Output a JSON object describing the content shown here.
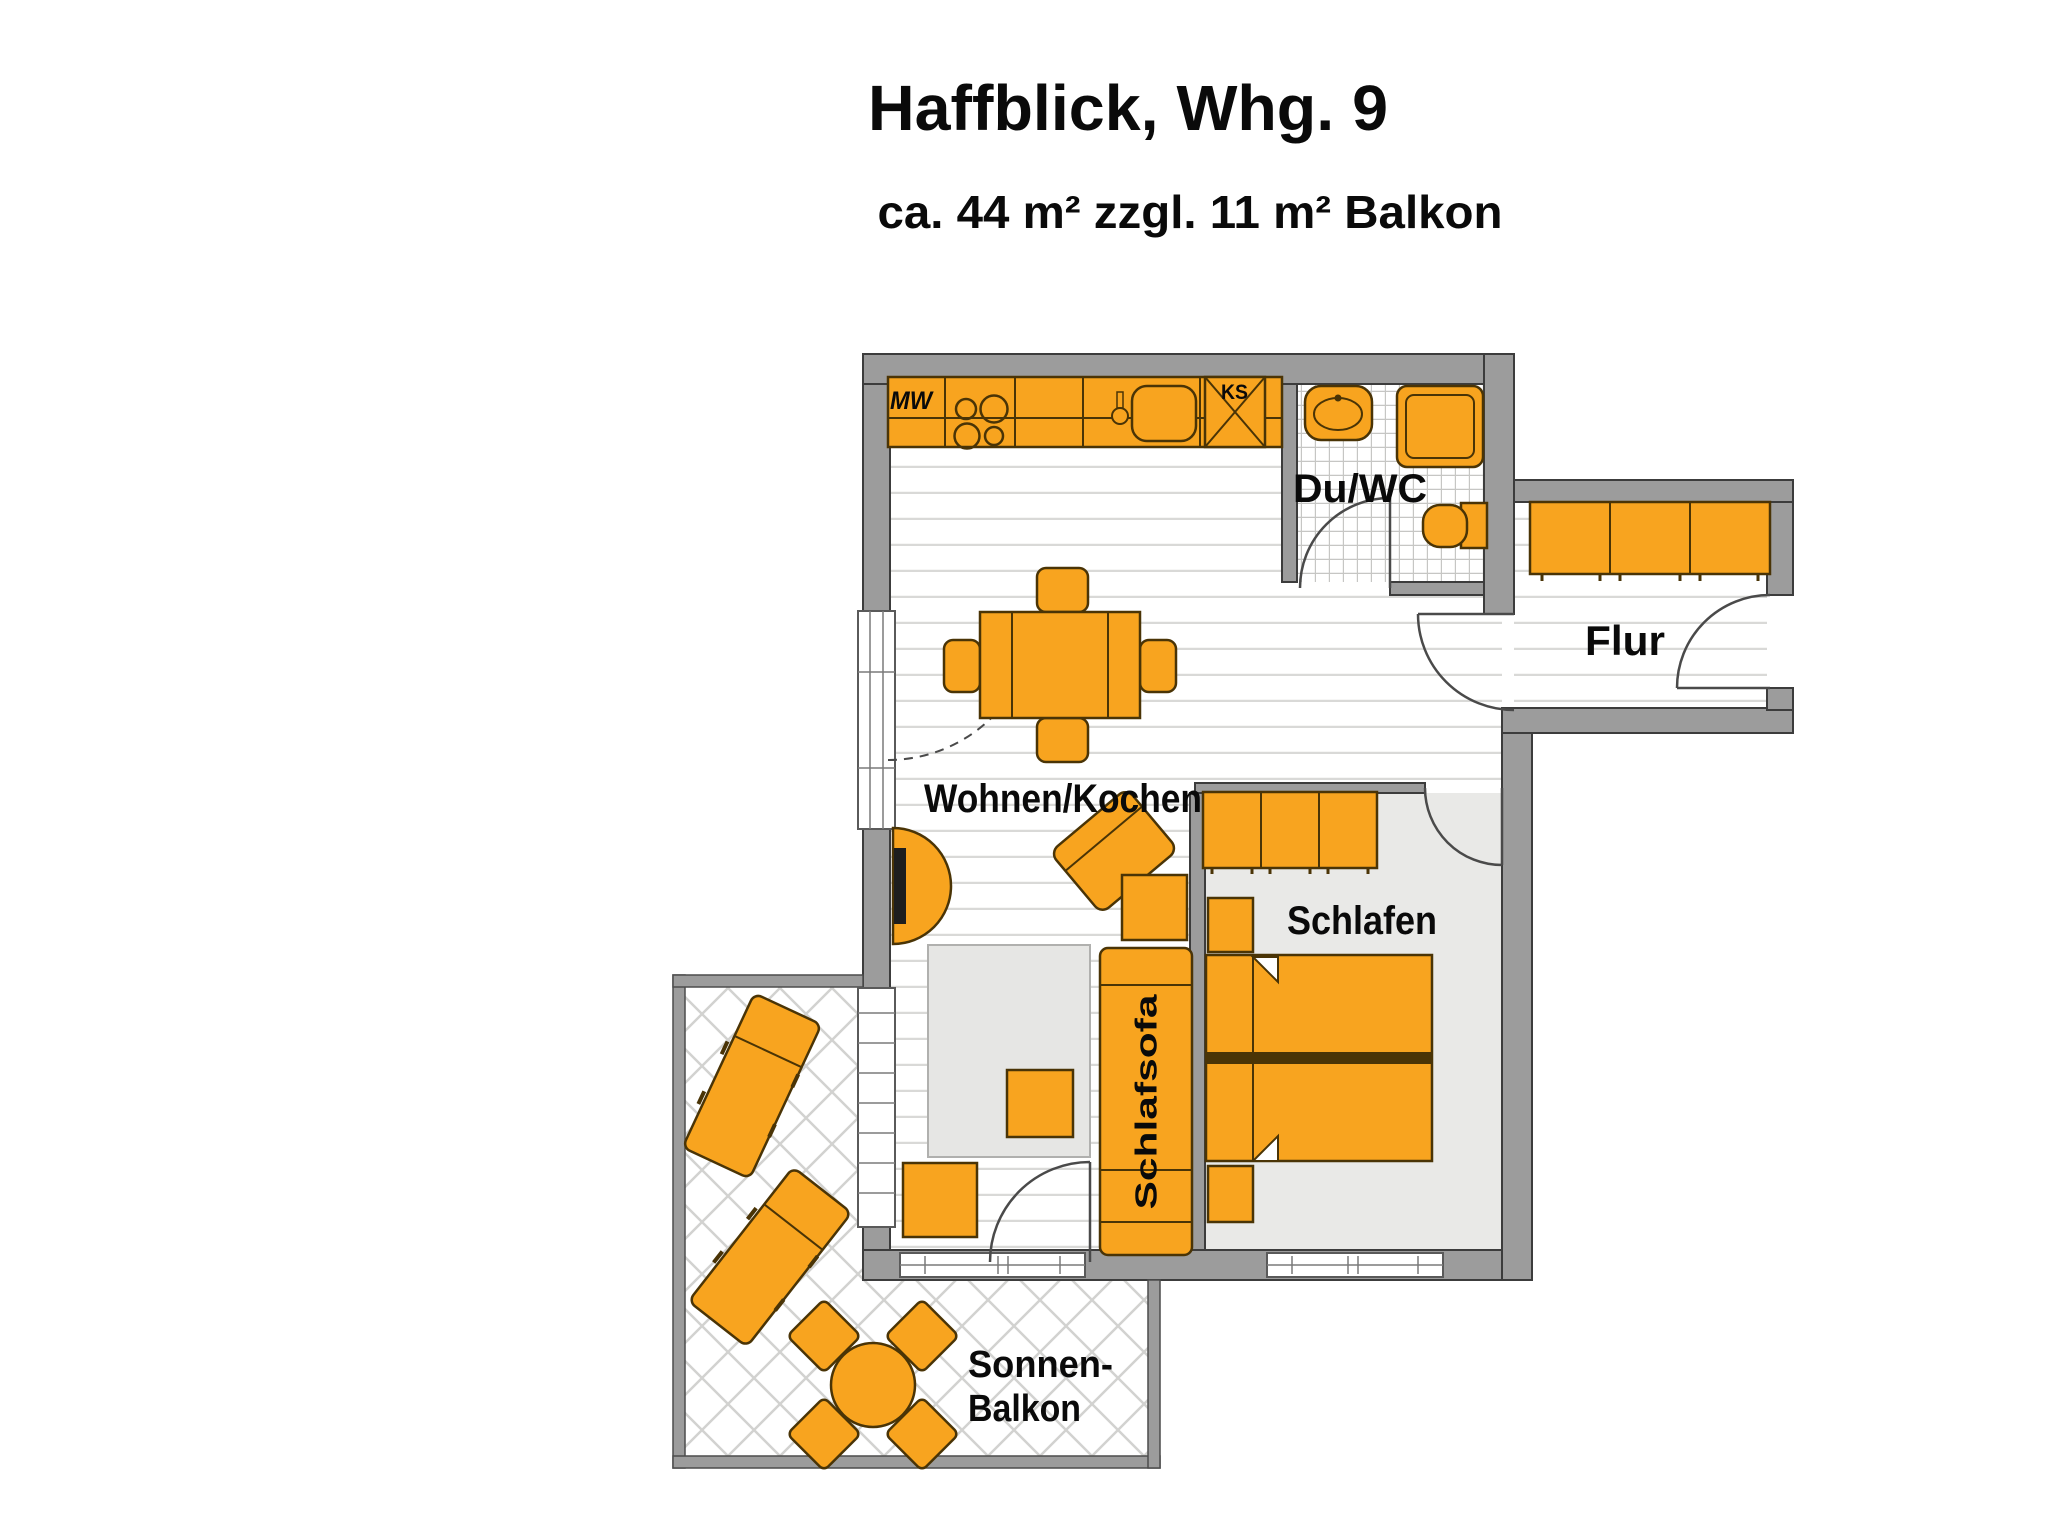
{
  "header": {
    "title": "Haffblick, Whg. 9",
    "subtitle": "ca. 44 m² zzgl. 11 m² Balkon"
  },
  "rooms": {
    "living_kitchen": "Wohnen/Kochen",
    "bedroom": "Schlafen",
    "shower_wc": "Du/WC",
    "hallway": "Flur",
    "balcony_line1": "Sonnen-",
    "balcony_line2": "Balkon"
  },
  "furniture": {
    "sleeper_sofa": "Schlafsofa",
    "microwave_abbr": "MW",
    "fridge_abbr": "KS"
  },
  "colors": {
    "furniture_orange": "#F8A41F",
    "furniture_outline": "#4A3406",
    "wall_gray": "#9C9C9C",
    "wall_outline": "#3C3C3C",
    "bedroom_floor": "#E9E9E7",
    "floor_line": "#D9D9D7"
  }
}
